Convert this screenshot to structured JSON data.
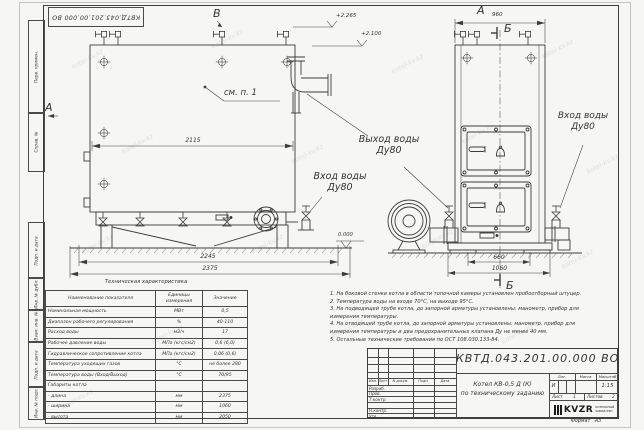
{
  "watermark": {
    "text": "kotel-kv.kz"
  },
  "corner_stamp": {
    "designation": "КВТД.043.201.00.000  ВО"
  },
  "margin_labels": {
    "items": [
      "Перв. примен.",
      "Справ. №",
      "Подп. и дата",
      "Инв. № дубл.",
      "Взам. инв. №",
      "Подп. и дата",
      "Инв. № подл."
    ]
  },
  "drawing": {
    "view_b_label": "В",
    "view_a_arrow_label": "А",
    "view_a_top_label": "А",
    "section_label_top": "Б",
    "section_label_bottom": "Б",
    "see_note": "см. п. 1",
    "dims": {
      "w2115": "2115",
      "w2245": "2245",
      "w2375": "2375",
      "w960": "960",
      "w660": "660",
      "w1060": "1060"
    },
    "elevations": {
      "top1": "+2.265",
      "top2": "+2.100",
      "zero": "0.000"
    },
    "ports": {
      "outlet_line1": "Выход воды",
      "outlet_line2": "Ду80",
      "inlet_left_line1": "Вход воды",
      "inlet_left_line2": "Ду80",
      "inlet_right_line1": "Вход воды",
      "inlet_right_line2": "Ду80"
    }
  },
  "tech_table": {
    "title": "Техническая характеристика",
    "headers": [
      "Наименование показателя",
      "Единицы измерения",
      "Значение"
    ],
    "rows": [
      [
        "Номинальная мощность",
        "МВт",
        "0,5"
      ],
      [
        "Диапазон рабочего регулирования",
        "%",
        "40-110"
      ],
      [
        "Расход воды",
        "м3/ч",
        "17"
      ],
      [
        "Рабочее давление воды",
        "МПа (кгс/см2)",
        "0,6 (6,0)"
      ],
      [
        "Гидравлическое сопротивление котла",
        "МПа (кгс/см2)",
        "0,06 (0,6)"
      ],
      [
        "Температура уходящих газов",
        "°С",
        "не более 280"
      ],
      [
        "Температура воды (Вход/Выход)",
        "°С",
        "70/95"
      ],
      [
        "Габариты котла",
        "",
        ""
      ],
      [
        "  - длина",
        "мм",
        "2375"
      ],
      [
        "  - ширина",
        "мм",
        "1060"
      ],
      [
        "  - высота",
        "мм",
        "2050"
      ]
    ]
  },
  "notes": {
    "lines": [
      "1. На боковой стенке котла в области топочной камеры установлен пробоотборный штуцер.",
      "2. Температура воды на входе 70°С, на выходе 95°С.",
      "3. На подводящей трубе котла, до запорной арматуры установлены: манометр, прибор для",
      "измерения температуры.",
      "4. На отводящей трубе котла, до запорной арматуры установлены: манометр, прибор для",
      "измерения температуры и два предохранительных клапана Ду не менее 40 мм.",
      "5. Остальные технические требования по ОСТ 108.030.133-84."
    ]
  },
  "title_block": {
    "designation": "КВТД.043.201.00.000  ВО",
    "name_line1": "Котел  КВ-0,5  Д  (К)",
    "name_line2": "по техническому заданию",
    "col_izm": "Изм.",
    "col_list": "Лист",
    "col_ndok": "N докум.",
    "col_podp": "Подп.",
    "col_data": "Дата",
    "role_1": "Разраб.",
    "role_2": "Пров.",
    "role_3": "Т.контр.",
    "role_4": "Н.контр.",
    "role_5": "Утв.",
    "lit_label": "Лит.",
    "mass_label": "Масса",
    "scale_label": "Масштаб",
    "lit_value": "И",
    "scale_value": "1:15",
    "sheet_label": "Лист",
    "sheet_value": "1",
    "sheets_label": "Листов",
    "sheets_value": "2",
    "logo": {
      "name": "KVZR",
      "sub1": "КОТЕЛЬНЫЙ",
      "sub2": "ЗАВОД РЭП"
    },
    "format_label": "Формат",
    "format_value": "А3"
  }
}
